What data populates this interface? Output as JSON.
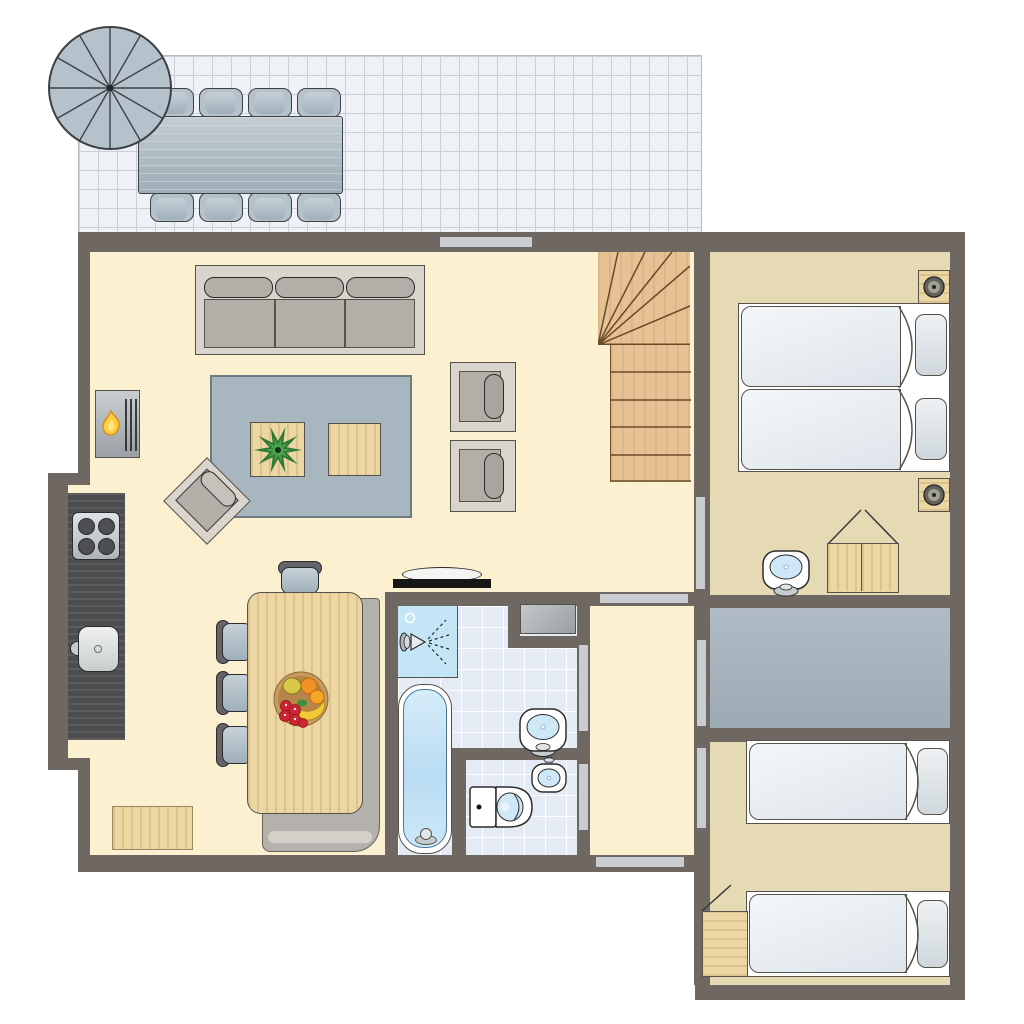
{
  "title": "Holiday home floor plan (top-down view, no text labels)",
  "palette": {
    "outside": "#ffffff",
    "wall": "#6f6761",
    "door": "#c9cdd1",
    "floor-main": "#fbf1d0",
    "floor-bedroom": "#e6dab4",
    "patio-tile": "#eef1f5",
    "patio-line": "#c9cfd6",
    "metal": "#b6c2cb",
    "metal-dark": "#3c4146",
    "metal-light": "#c6d0d7",
    "rug": "#a8b6c0",
    "rug-border": "#6e7b83",
    "sofa-frame": "#d9d5cd",
    "cushion": "#b3aea7",
    "outline": "#55524c",
    "wood": "#ecd6a4",
    "stairs-wood": "#e6c193",
    "stairs-line": "#6b4a2a",
    "counter": "#4e4d4f",
    "island-base": "#b4b0ab",
    "bath-tile": "#e4ebf4",
    "shower": "#c3e5f5",
    "water": "#cfe8f7",
    "utility-a": "#b0bbc4",
    "utility-b": "#9dabb6",
    "duvet-a": "#f4f7f9",
    "duvet-b": "#dde4ea",
    "pillow-a": "#eef1f3",
    "pillow-b": "#cfd7dc",
    "flame": "#ffce3a",
    "flame-edge": "#d98a1d",
    "plant-dark": "#2f7a33",
    "plant-mid": "#4ca24f",
    "bowl": "#c89a5e",
    "fruit-orange": "#ef9227",
    "fruit-banana": "#f2c937",
    "fruit-red": "#cf2633",
    "washer-a": "#c2c7ca",
    "washer-b": "#9aa0a3",
    "fixture-white": "#ffffff"
  },
  "rooms": [
    {
      "id": "terrace",
      "furniture": [
        "parasol",
        "dining-table",
        "dining-chair-x8"
      ]
    },
    {
      "id": "living-room",
      "furniture": [
        "sofa",
        "rug",
        "side-table-with-plant",
        "side-table",
        "rotated-armchair",
        "fireplace",
        "armchair-x2",
        "tv"
      ]
    },
    {
      "id": "kitchen",
      "furniture": [
        "counter",
        "stove",
        "kitchen-sink",
        "island-base",
        "island-table",
        "bar-stool-x4",
        "fruit-bowl",
        "floor-mat"
      ]
    },
    {
      "id": "staircase",
      "furniture": [
        "winder-stairs"
      ]
    },
    {
      "id": "bathroom",
      "furniture": [
        "shower",
        "bathtub",
        "washbasin",
        "washing-machine"
      ]
    },
    {
      "id": "toilet-room",
      "furniture": [
        "toilet",
        "corner-washbasin"
      ]
    },
    {
      "id": "hallway",
      "furniture": []
    },
    {
      "id": "bedroom-1",
      "furniture": [
        "double-bed",
        "nightstand-with-lamp-x2",
        "washbasin",
        "wardrobe"
      ]
    },
    {
      "id": "utility-room",
      "furniture": []
    },
    {
      "id": "bedroom-2",
      "furniture": [
        "single-bed-x2",
        "cabinet"
      ]
    }
  ],
  "openings": [
    "window-top-wall",
    "door-living-to-bedroom-1",
    "door-hall-top",
    "door-hall-to-utility",
    "door-hall-to-bedroom-2",
    "door-hall-to-bathroom",
    "door-hall-to-toilet",
    "door-hall-exterior"
  ]
}
